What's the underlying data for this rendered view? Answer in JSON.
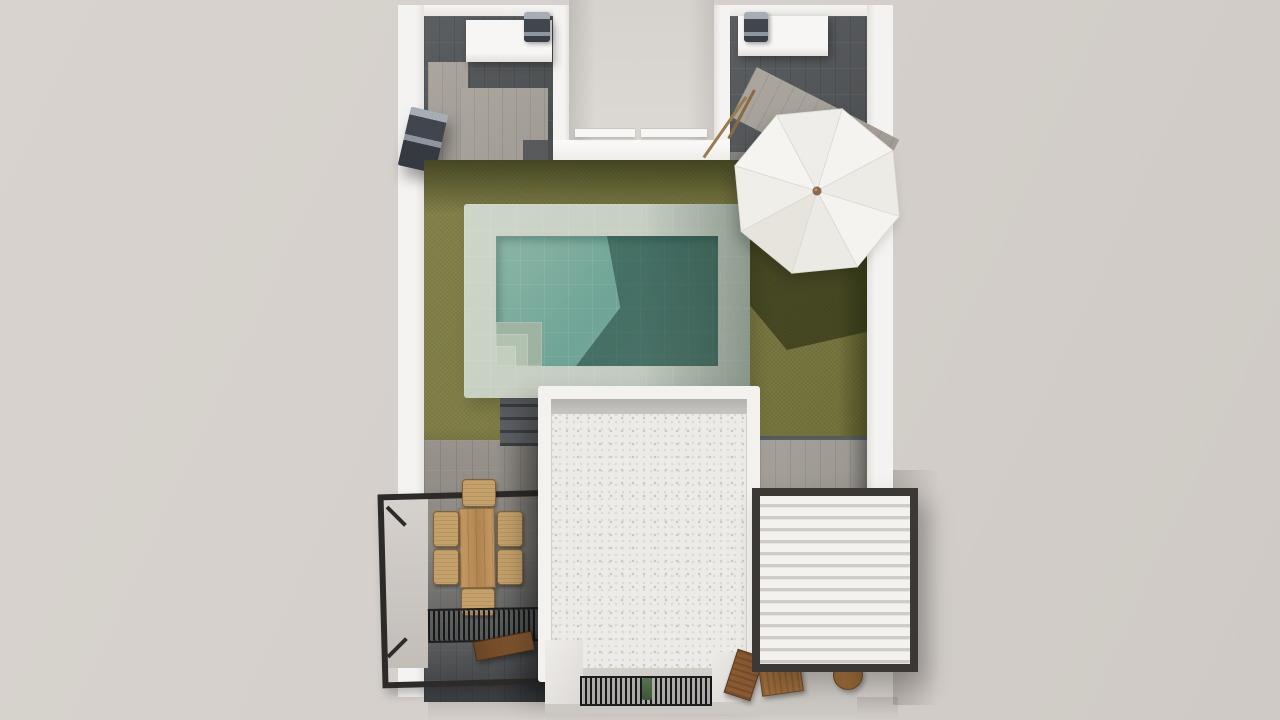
{
  "scene": {
    "type": "3d-architectural-render",
    "view": "top-down",
    "description": "Top-down 3D render of a villa plot: white perimeter walls, two upper stone patios with white counters and barbecue grills, a recessed entry notch, an olive-green lawn with a rectangular pool with pale tile surround and corner steps, a white octagonal parasol casting a shadow, a white gravel flat roof, a lower dining terrace with a wooden table and six wicker chairs inside a black metal railing, slatted dark grates, a wooden bench, and a white louvered pergola with a dark frame at lower right.",
    "objects": [
      {
        "name": "perimeter-walls",
        "description": "white plastered walls around the plot"
      },
      {
        "name": "patio-upper-left",
        "description": "stone-paved courtyard with white counter and barbecue grill"
      },
      {
        "name": "patio-upper-right",
        "description": "stone-paved courtyard with white counter, grill, leaning broom"
      },
      {
        "name": "entry-notch",
        "description": "recessed opening between the two upper patios with white sills"
      },
      {
        "name": "ac-unit",
        "description": "dark wall-mounted unit on the left wall"
      },
      {
        "name": "lawn",
        "description": "olive green artificial grass with wall and parasol shadows"
      },
      {
        "name": "pool",
        "description": "rectangular pool, pale mint tile surround, teal water, corner steps, shadow across water"
      },
      {
        "name": "parasol",
        "description": "white octagonal umbrella with eight panels and wooden hub"
      },
      {
        "name": "house-roof",
        "description": "white flat roof with gravel texture and rim"
      },
      {
        "name": "dining-terrace",
        "description": "lower terrace with wooden table, six wicker chairs, black railing frame"
      },
      {
        "name": "slatted-grates",
        "description": "dark thin-slat grates on terrace and at bottom entrance"
      },
      {
        "name": "bench",
        "description": "dark wooden bench on the terrace"
      },
      {
        "name": "louvered-pergola",
        "description": "white louvered roof in dark metal frame, lower right"
      },
      {
        "name": "outdoor-chairs-bottom",
        "description": "wooden chairs and round side table at bottom edge"
      }
    ]
  },
  "colors": {
    "background": "#d5d0cb",
    "wall_white": "#f4f3f1",
    "slate_paving": "#515456",
    "light_paving": "#a5a19a",
    "grass": "#7b7941",
    "grass_shadow": "#1c2009",
    "pool_tile": "#c4cdc0",
    "pool_water": "#6fa496",
    "pool_water_shadow": "#122e28",
    "roof_gravel": "#edebe8",
    "louver_white": "#f4f2ef",
    "frame_black": "#2d2b29",
    "pergola_frame": "#3b3835",
    "table_wood": "#c59a63",
    "chair_wicker": "#c4a06a",
    "bench_wood": "#6b4524",
    "umbrella_white": "#f5f3f0",
    "umbrella_alt": "#edeae6",
    "metal_unit": "#41454e"
  }
}
